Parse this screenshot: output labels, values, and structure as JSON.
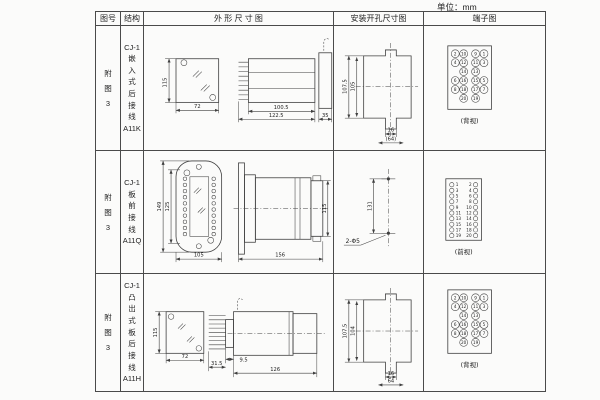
{
  "unit_label": "单位：mm",
  "header": {
    "fig": "图号",
    "struct": "结构",
    "outline": "外 形 尺 寸 图",
    "mounting": "安装开孔尺寸图",
    "terminal": "端子图"
  },
  "rows": [
    {
      "fig": "附\n图\n3",
      "struct": "CJ-1\n嵌\n入\n式\n后\n接\n线\nA11K",
      "outline": {
        "front_h": "115",
        "front_w": "72",
        "body_w": "100.5",
        "total_w": "122.5",
        "flange_w": "35"
      },
      "mounting": {
        "outer_h": "107.5",
        "inner_h": "105",
        "tab_w": "16",
        "base_w": "(64)"
      },
      "terminal_view": "(背视)"
    },
    {
      "fig": "附\n图\n3",
      "struct": "CJ-1\n板\n前\n接\n线\nA11Q",
      "outline": {
        "outer_h": "149",
        "inner_h": "125",
        "front_w": "105",
        "total_w": "156",
        "side_h": "115"
      },
      "mounting": {
        "hole_dist": "131",
        "holes": "2-Φ5"
      },
      "terminal_view": "(前视)"
    },
    {
      "fig": "附\n图\n3",
      "struct": "CJ-1\n凸\n出\n式\n板\n后\n接\n线\nA11H",
      "outline": {
        "front_h": "115",
        "front_w": "72",
        "pin_d": "9.5",
        "proj": "31.5",
        "total_w": "126"
      },
      "mounting": {
        "outer_h": "107.5",
        "inner_h": "104",
        "tab_w": "16",
        "base_w": "64"
      },
      "terminal_view": "(背视)"
    }
  ],
  "terminals": {
    "back": [
      "2",
      "10",
      "9",
      "1",
      "4",
      "12",
      "11",
      "3",
      "14",
      "13",
      "6",
      "16",
      "15",
      "5",
      "8",
      "18",
      "17",
      "7",
      "20",
      "19"
    ],
    "front_left": [
      "1",
      "3",
      "5",
      "7",
      "9",
      "11",
      "13",
      "15",
      "17",
      "19"
    ],
    "front_right": [
      "2",
      "4",
      "6",
      "8",
      "10",
      "12",
      "14",
      "16",
      "18",
      "20"
    ]
  }
}
